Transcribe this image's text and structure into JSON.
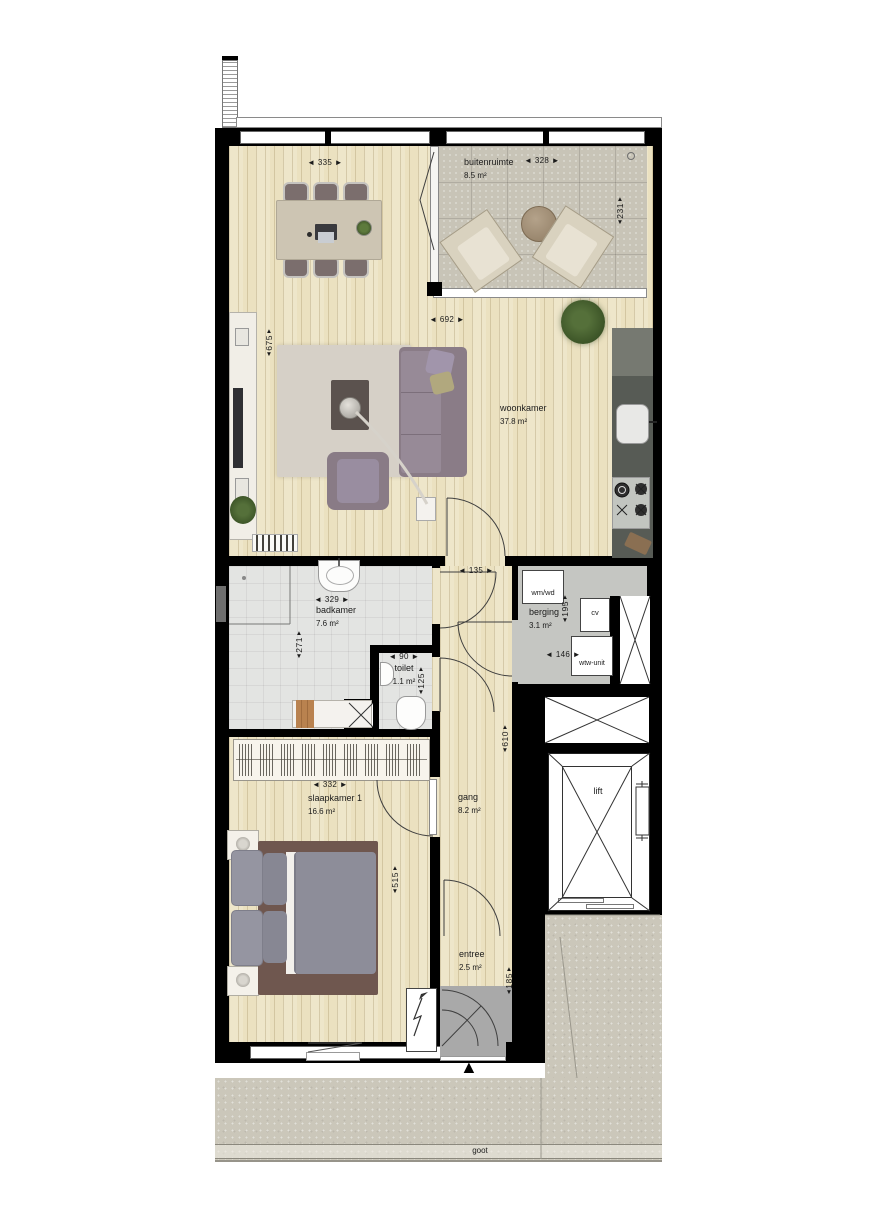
{
  "plan": {
    "rooms": {
      "buitenruimte": {
        "name": "buitenruimte",
        "area": "8.5 m²"
      },
      "woonkamer": {
        "name": "woonkamer",
        "area": "37.8 m²"
      },
      "badkamer": {
        "name": "badkamer",
        "area": "7.6 m²"
      },
      "toilet": {
        "name": "toilet",
        "area": "1.1 m²"
      },
      "berging": {
        "name": "berging",
        "area": "3.1 m²"
      },
      "gang": {
        "name": "gang",
        "area": "8.2 m²"
      },
      "slaapkamer1": {
        "name": "slaapkamer 1",
        "area": "16.6 m²"
      },
      "entree": {
        "name": "entree",
        "area": "2.5 m²"
      },
      "lift": {
        "name": "lift"
      }
    },
    "dimensions_cm": {
      "dining_width": "◄ 335 ►",
      "balcony_width": "◄ 328 ►",
      "balcony_depth": "231",
      "living_width": "◄ 692 ►",
      "living_depth": "675",
      "hall_passage_width": "◄ 135 ►",
      "bath_width": "◄ 329 ►",
      "bath_depth": "271",
      "toilet_width": "◄ 90 ►",
      "toilet_depth": "125",
      "storage_depth": "195",
      "storage_width": "◄ 146 ►",
      "hall_depth": "610",
      "bedroom_width": "◄ 332 ►",
      "bedroom_depth": "515",
      "entree_depth": "185"
    },
    "equipment_labels": {
      "washer": "wm/wd",
      "boiler": "cv",
      "heat_recovery": "wtw-unit"
    },
    "exterior_labels": {
      "gutter": "goot"
    },
    "icons": {
      "dim_arrow_up": "▲",
      "dim_arrow_down": "▼",
      "entrance_arrow": "▲"
    },
    "colors": {
      "wall": "#000000",
      "wood_floor": "#ebe1c0",
      "balcony_tile": "#c8c4b7",
      "bath_tile": "#e3e4e2",
      "storage_floor": "#c5c6c2",
      "entree_mat": "#a9a9a9",
      "gallery_gravel": "#cbc7ba",
      "kitchen_counter": "#575b55",
      "sofa": "#8a7c87",
      "bed_duvet": "#8d8d99",
      "bed_frame": "#6f574f",
      "dining_table": "#cdc5b3"
    }
  }
}
